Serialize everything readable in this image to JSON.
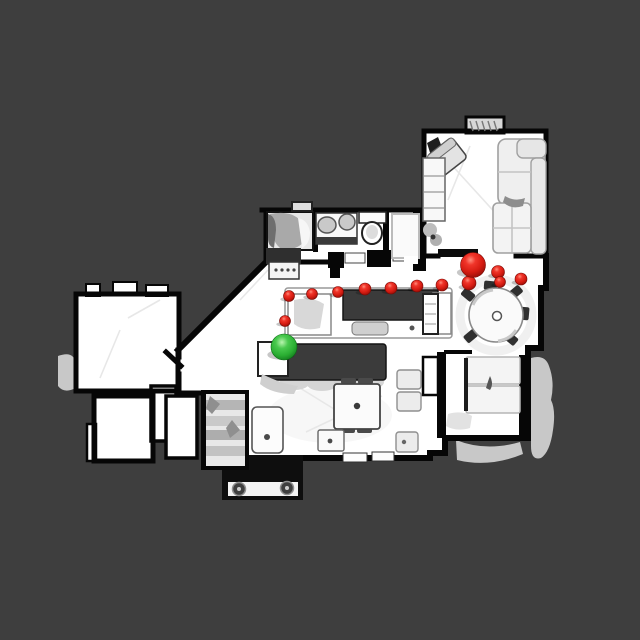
{
  "scene": {
    "background_color": "#3E3E3E",
    "floor_color": "#FFFFFF",
    "wall_color": "#060606",
    "view": "top-down-floorplan"
  },
  "navigation": {
    "path_color": "#D61C12",
    "robot_marker": {
      "name": "start-green-sphere",
      "color": "#2AAE32",
      "x": 284,
      "y": 347,
      "r": 13
    },
    "goal_marker": {
      "name": "goal-red-sphere",
      "color": "#D61C12",
      "x": 473,
      "y": 265,
      "r": 12.5
    },
    "waypoints": [
      {
        "x": 285,
        "y": 321,
        "r": 5.5
      },
      {
        "x": 289,
        "y": 296,
        "r": 5.5
      },
      {
        "x": 312,
        "y": 294,
        "r": 5.5
      },
      {
        "x": 338,
        "y": 292,
        "r": 5.5
      },
      {
        "x": 365,
        "y": 289,
        "r": 6
      },
      {
        "x": 391,
        "y": 288,
        "r": 6
      },
      {
        "x": 417,
        "y": 286,
        "r": 6
      },
      {
        "x": 442,
        "y": 285,
        "r": 6
      },
      {
        "x": 469,
        "y": 283,
        "r": 7
      },
      {
        "x": 498,
        "y": 272,
        "r": 6.5
      },
      {
        "x": 500,
        "y": 282,
        "r": 5.5
      },
      {
        "x": 521,
        "y": 279,
        "r": 6
      }
    ]
  }
}
